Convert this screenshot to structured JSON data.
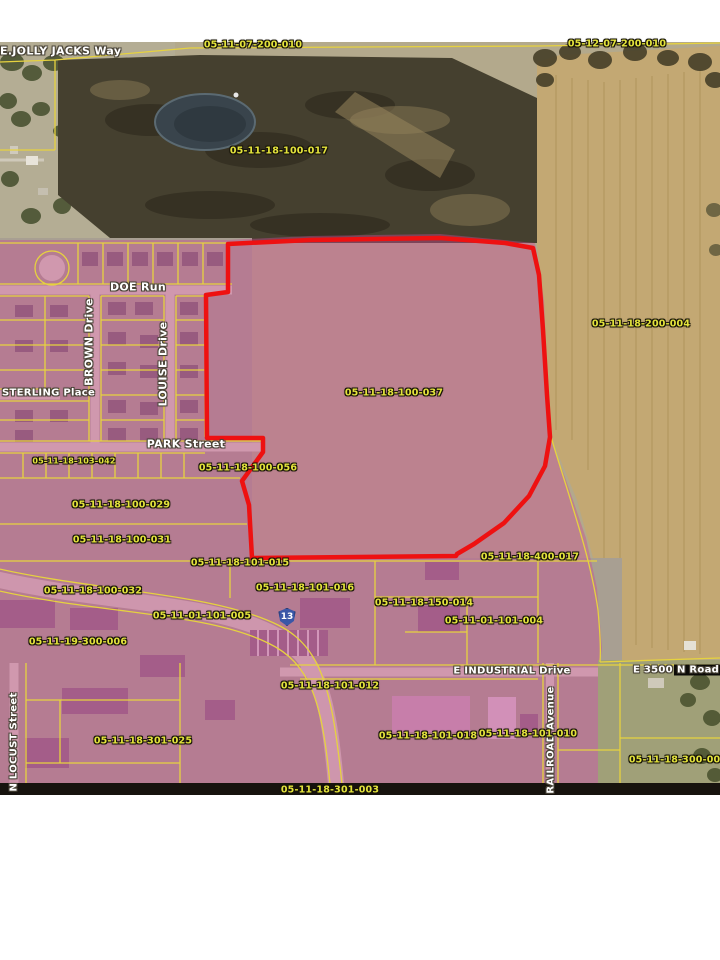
{
  "map": {
    "title": "Aerial parcel map with highlighted parcel",
    "streets": {
      "jolly_jacks": "E.JOLLY JACKS Way",
      "doe_run": "DOE Run",
      "brown_drive": "BROWN Drive",
      "louise_drive": "LOUISE Drive",
      "sterling_place": "STERLING Place",
      "park_street": "PARK Street",
      "n_locust_street": "N LOCUST Street",
      "industrial_drive": "E INDUSTRIAL Drive",
      "road_3500n_prefix": "E 3500",
      "road_3500n_suffix": "N Road",
      "railroad_avenue": "RAILROAD Avenue"
    },
    "highway_shield": "13",
    "highlighted_parcel": "05-11-18-100-037",
    "parcels": [
      "05-11-07-200-010",
      "05-12-07-200-010",
      "05-11-18-100-017",
      "05-11-18-200-004",
      "05-11-18-100-037",
      "05-11-18-103-042",
      "05-11-18-100-056",
      "05-11-18-100-029",
      "05-11-18-100-031",
      "05-11-18-101-015",
      "05-11-18-400-017",
      "05-11-18-101-016",
      "05-11-18-100-032",
      "05-11-18-150-014",
      "05-11-01-101-004",
      "05-11-01-101-005",
      "05-11-19-300-006",
      "05-11-18-101-012",
      "05-11-18-101-018",
      "05-11-18-101-010",
      "05-11-18-301-025",
      "05-11-18-300-006",
      "05-11-18-301-003"
    ],
    "colors": {
      "parcel_label": "#e3e33c",
      "street_label": "#ffffff",
      "highlight_outline": "#ee1111",
      "overlay_pink": "#c74c94",
      "parcel_lines": "#e6d23f",
      "shield_blue": "#3a57a7"
    }
  }
}
